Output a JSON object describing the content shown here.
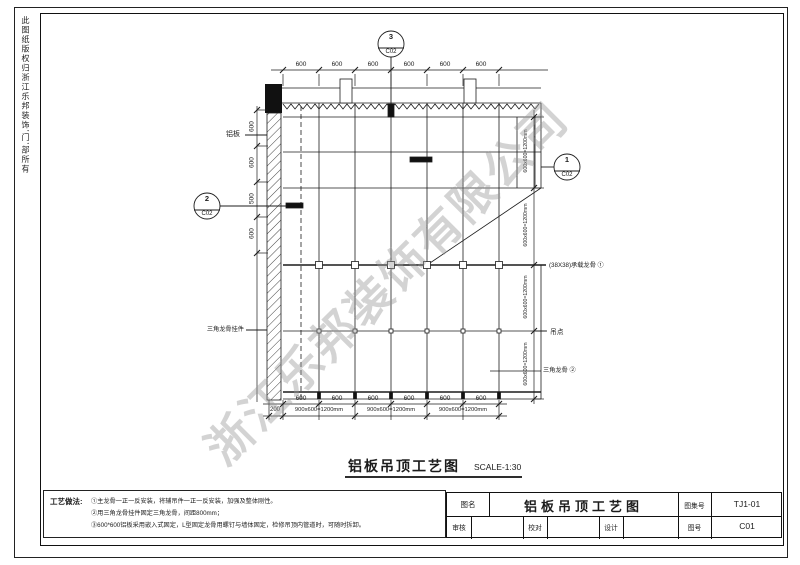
{
  "sheet": {
    "side_text": "此图纸版权归浙江乐邦装饰'门'部所有",
    "watermark": "浙江乐邦装饰有限公司"
  },
  "drawing": {
    "labels": {
      "aluminum_panel": "铝板",
      "triangle_keel_hanger": "三角龙骨挂件",
      "carrier_keel": "(38X38)承载龙骨 ①",
      "hanging_point": "吊点",
      "triangle_keel": "三角龙骨 ②"
    },
    "callouts": {
      "c1": {
        "num": "1",
        "sheet": "C02"
      },
      "c2": {
        "num": "2",
        "sheet": "C02"
      },
      "c3": {
        "num": "3",
        "sheet": "C02"
      }
    },
    "dims": {
      "top": [
        "600",
        "600",
        "600",
        "600",
        "600",
        "600"
      ],
      "left": [
        "600",
        "600",
        "500",
        "600"
      ],
      "right": [
        "600x600=1200mm",
        "600x600=1200mm",
        "600x600=1200mm",
        "600x600=1200mm"
      ],
      "bottom_600": [
        "600",
        "600",
        "600",
        "600",
        "600",
        "600"
      ],
      "bottom_200": "200",
      "bottom_1200": [
        "900x600=1200mm",
        "900x600=1200mm",
        "900x600=1200mm"
      ]
    },
    "title": "铝板吊顶工艺图",
    "scale": "SCALE-1:30"
  },
  "notes": {
    "label": "工艺做法:",
    "lines": [
      "①主龙骨一正一反安装，将辅吊件一正一反安装，加强及整体刚性。",
      "②用三角龙骨挂件固定三角龙骨，间距800mm；",
      "③600*600铝板采用嵌入式固定，L型固定龙骨用螺钉与墙体固定，检修吊顶内管道时，可随时拆卸。"
    ]
  },
  "titleblock": {
    "name_label": "图名",
    "name_value": "铝板吊顶工艺图",
    "set_label": "图集号",
    "set_value": "TJ1-01",
    "review_label": "审核",
    "check_label": "校对",
    "design_label": "设计",
    "no_label": "图号",
    "no_value": "C01"
  }
}
